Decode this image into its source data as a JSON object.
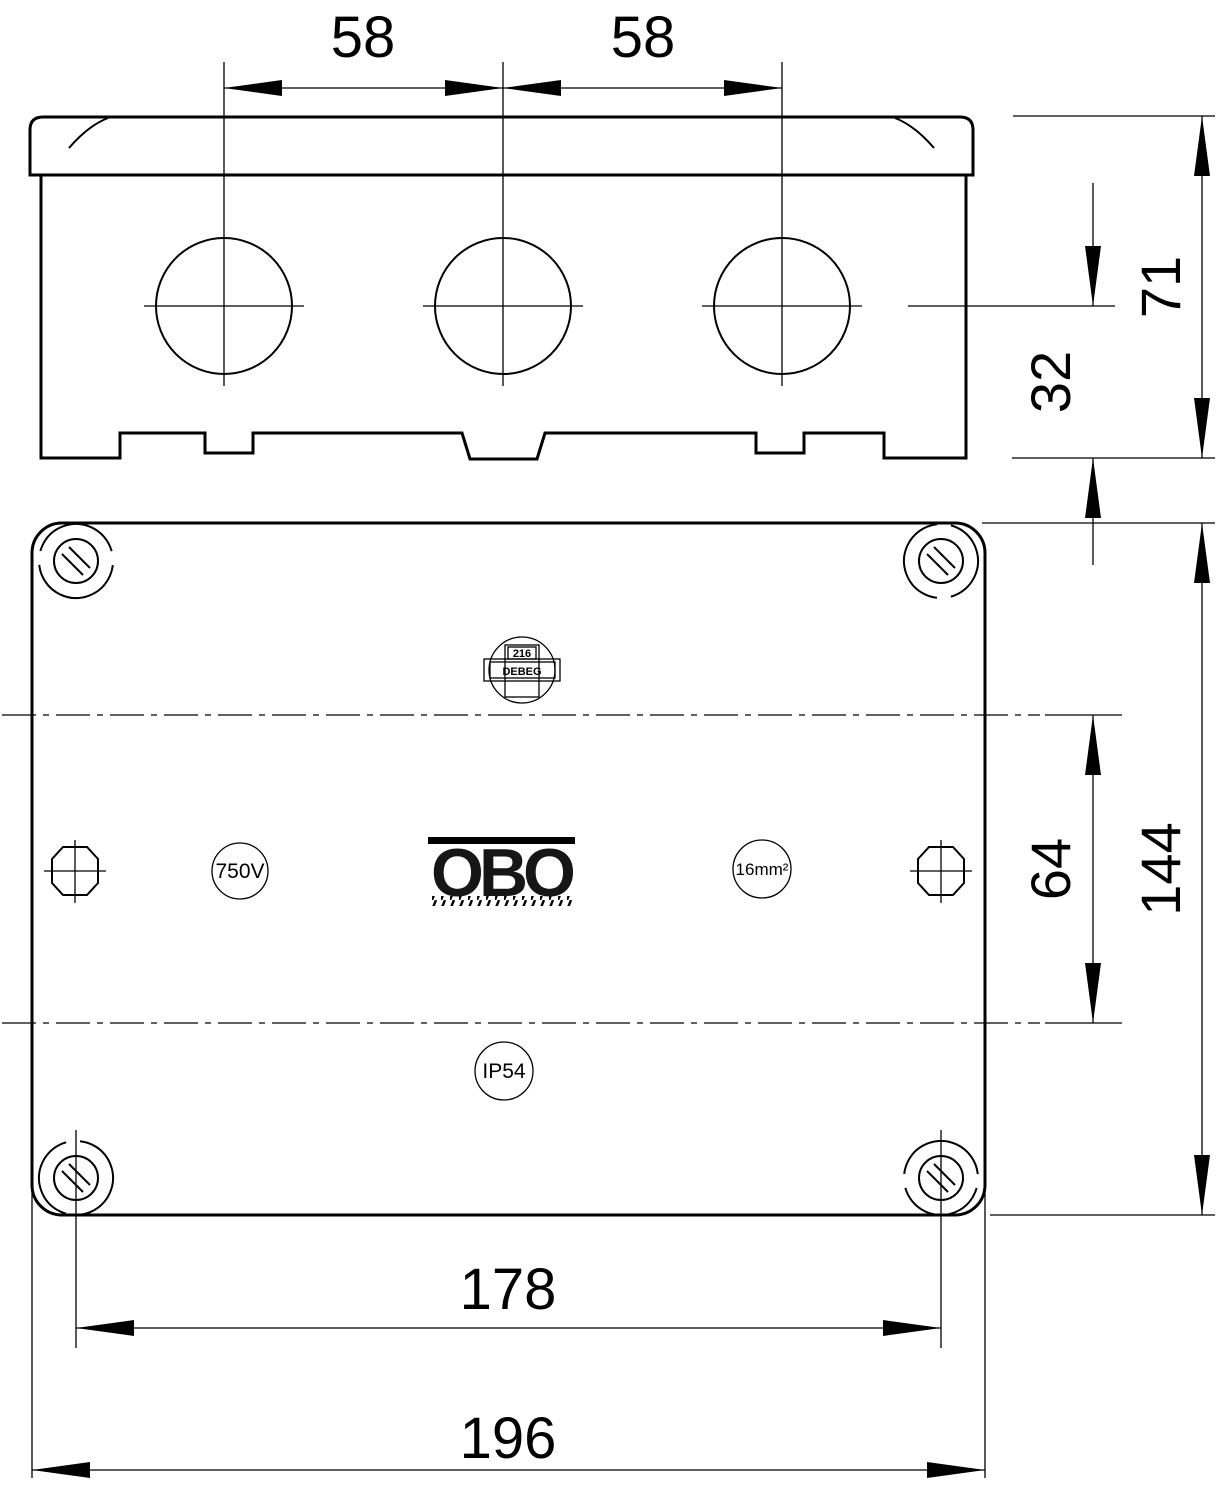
{
  "title": "OBO junction box dimensional drawing",
  "dimensions": {
    "d58_left": "58",
    "d58_right": "58",
    "d71": "71",
    "d32": "32",
    "d64": "64",
    "d144": "144",
    "d178": "178",
    "d196": "196"
  },
  "markings": {
    "logo": "OBO",
    "voltage": "750V",
    "cross_section": "16mm²",
    "protection": "IP54",
    "badge_number": "216",
    "badge_name": "DEBEG"
  }
}
